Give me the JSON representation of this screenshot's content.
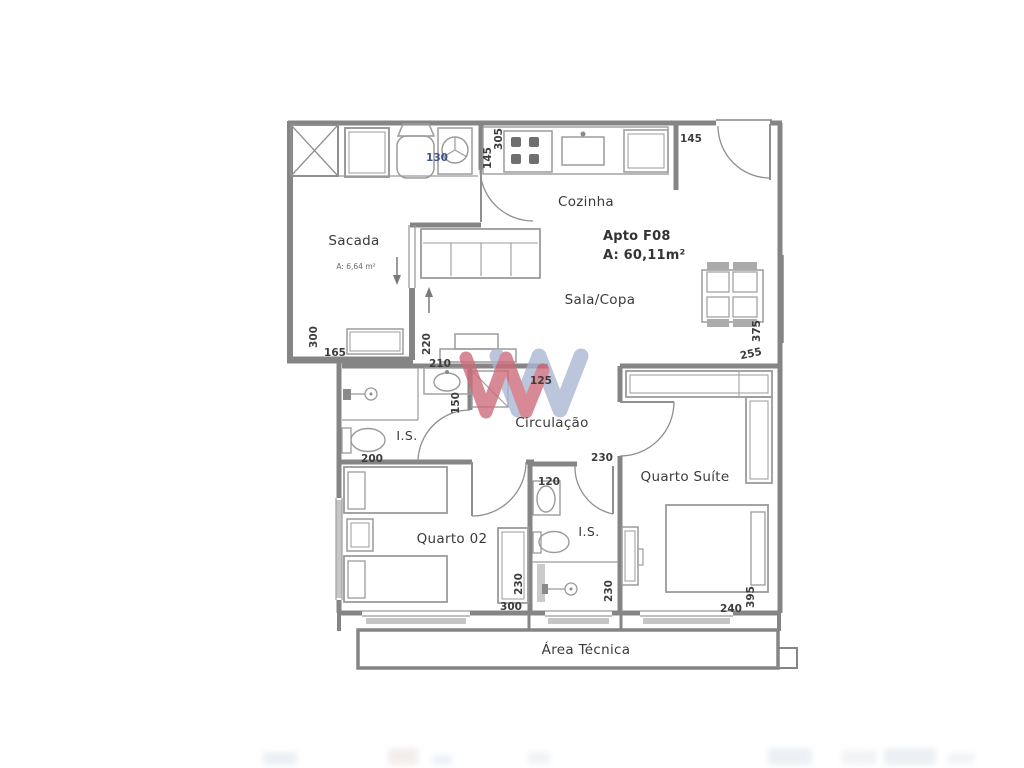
{
  "plan_title": {
    "apto": "Apto F08",
    "area": "A: 60,11m²"
  },
  "rooms": {
    "sacada": {
      "label": "Sacada",
      "area": "A: 6,64 m²"
    },
    "cozinha": {
      "label": "Cozinha"
    },
    "sala": {
      "label": "Sala/Copa"
    },
    "is1": {
      "label": "I.S."
    },
    "circulacao": {
      "label": "Circulação"
    },
    "quarto_suite": {
      "label": "Quarto Suíte"
    },
    "quarto02": {
      "label": "Quarto 02"
    },
    "is2": {
      "label": "I.S."
    },
    "area_tecnica": {
      "label": "Área Técnica"
    }
  },
  "dims": {
    "d130": "130",
    "d305": "305",
    "d145_kitchen": "145",
    "d145_entry": "145",
    "d375": "375",
    "d255": "255",
    "d300_sacada": "300",
    "d165": "165",
    "d220": "220",
    "d210": "210",
    "d150": "150",
    "d125": "125",
    "d200": "200",
    "d230_circ": "230",
    "d120": "120",
    "d230_quarto02": "230",
    "d300_quarto02": "300",
    "d230_is2": "230",
    "d240": "240",
    "d395": "395"
  },
  "colors": {
    "wall": "#858585",
    "furniture": "#9b9b9b",
    "label": "#3a3a3a",
    "dimension": "#3d3d3d",
    "dimension_alt": "#3e5288",
    "watermark_blue": "#a9b5d2",
    "watermark_red": "#cd6a79",
    "window": "#c6c6c6"
  }
}
